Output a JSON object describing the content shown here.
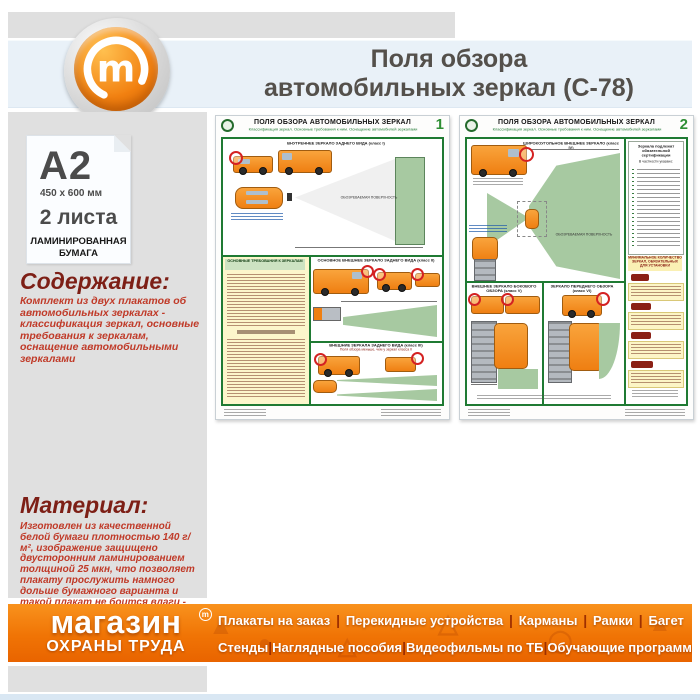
{
  "window": {
    "title_line1": "Поля обзора",
    "title_line2": "автомобильных зеркал (С-78)"
  },
  "product": {
    "format": "A2",
    "dimensions": "450 x 600 мм",
    "sheets": "2 листа",
    "paper_line1": "ЛАМИНИРОВАННАЯ",
    "paper_line2": "БУМАГА"
  },
  "content_section": {
    "heading": "Содержание:",
    "text": "Комплект из двух плакатов об автомобильных зеркалах - классификация зеркал, основные требования к зеркалам, оснащение автомобильными зеркалами"
  },
  "material_section": {
    "heading": "Материал:",
    "text": "Изготовлен из качественной белой бумаги плотностью 140 г/м², изображение защищено двусторонним ламинированием толщиной 25 мкн, что позволяет плакату прослужить намного дольше бумажного варианта и такой плакат не боится влаги - его смело можно протирать."
  },
  "posters": [
    {
      "number": "1",
      "title": "ПОЛЯ ОБЗОРА АВТОМОБИЛЬНЫХ ЗЕРКАЛ",
      "subtitle": "Классификация зеркал. Основные требования к ним. Оснащение автомобилей зеркалами",
      "section_class1": "ВНУТРЕННЕЕ ЗЕРКАЛО ЗАДНЕГО ВИДА (класс I)",
      "requirements_heading": "ОСНОВНЫЕ ТРЕБОВАНИЯ К ЗЕРКАЛАМ",
      "section_class2": "ОСНОВНОЕ ВНЕШНЕЕ ЗЕРКАЛО ЗАДНЕГО ВИДА (класс II)",
      "section_class3": "ВНЕШНИЕ ЗЕРКАЛА ЗАДНЕГО ВИДА (класс III)",
      "section_class3_note": "Поля обзора меньше, чем у зеркал класса II",
      "surface_label": "ОБОЗРЕВАЕМАЯ ПОВЕРХНОСТЬ"
    },
    {
      "number": "2",
      "title": "ПОЛЯ ОБЗОРА АВТОМОБИЛЬНЫХ ЗЕРКАЛ",
      "subtitle": "Классификация зеркал. Основные требования к ним. Оснащение автомобилей зеркалами",
      "section_class4": "ШИРОКОУГОЛЬНОЕ ВНЕШНЕЕ ЗЕРКАЛО (класс IV)",
      "certification_title": "Зеркала подлежат обязательной сертификации",
      "certification_sub": "В частности указано:",
      "min_mirrors_heading": "МИНИМАЛЬНОЕ КОЛИЧЕСТВО ЗЕРКАЛ, ОБЯЗАТЕЛЬНЫХ ДЛЯ УСТАНОВКИ",
      "section_class5": "ВНЕШНЕЕ ЗЕРКАЛО БОКОВОГО ОБЗОРА (класс V)",
      "section_class6": "ЗЕРКАЛО ПЕРЕДНЕГО ОБЗОРА (класс VI)",
      "surface_label": "ОБОЗРЕВАЕМАЯ ПОВЕРХНОСТЬ"
    }
  ],
  "footer": {
    "brand_line1": "магазин",
    "brand_mark": "m",
    "brand_line2": "ОХРАНЫ ТРУДА",
    "separator": "|",
    "menu_row1": [
      "Плакаты на заказ",
      "Перекидные устройства",
      "Карманы",
      "Рамки",
      "Багет"
    ],
    "menu_row2": [
      "Стенды",
      "Наглядные пособия",
      "Видеофильмы по ТБ",
      "Обучающие программы"
    ]
  },
  "logo": {
    "letter": "m"
  },
  "colors": {
    "accent_orange": "#f47a0c",
    "poster_green": "#1f7a33",
    "field_green": "#a7c9a1",
    "heading_maroon": "#7d1f16",
    "body_red": "#c03a28",
    "band_blue": "#e9f1f8",
    "panel_gray": "#e0e0e0",
    "vehicle_orange": "#f28a1e",
    "footer_separator": "#9e2f00"
  }
}
